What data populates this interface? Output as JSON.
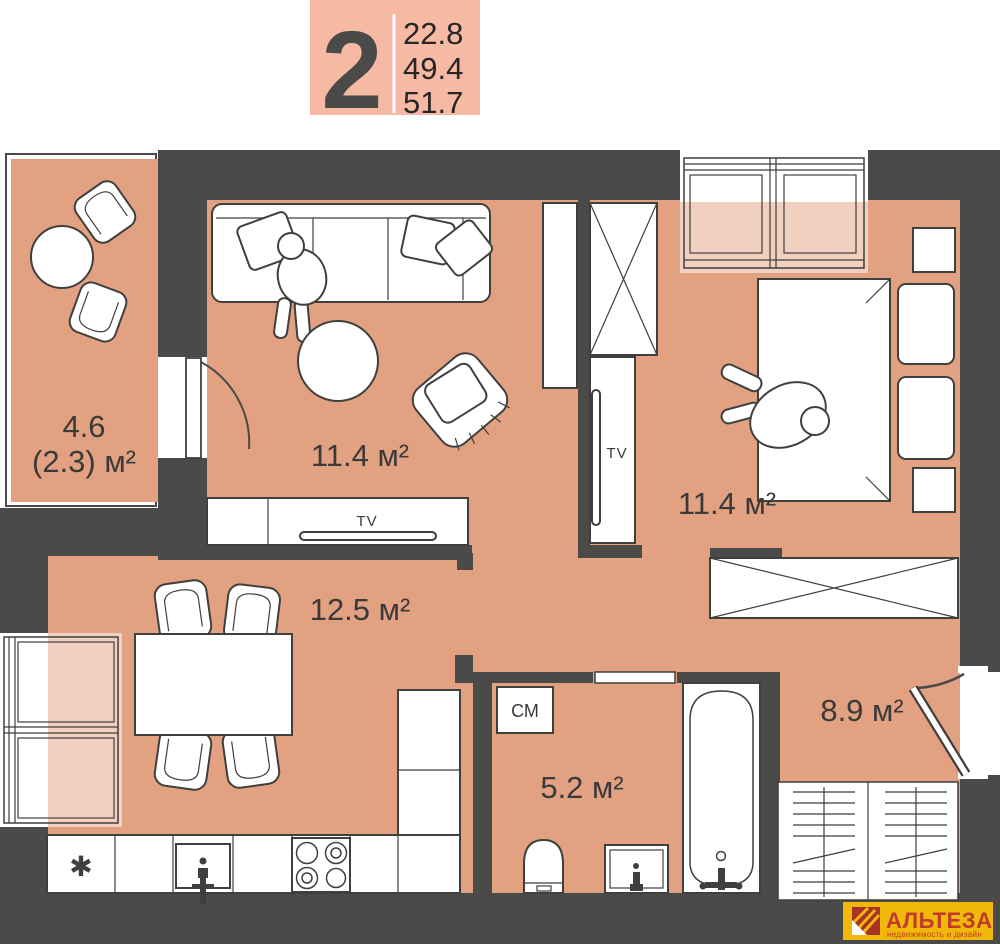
{
  "badge": {
    "rooms_count": "2",
    "areas": [
      "22.8",
      "49.4",
      "51.7"
    ]
  },
  "labels": {
    "balcony_area": "4.6",
    "balcony_area_reduced": "(2.3) м²",
    "living_room_area": "11.4 м²",
    "bedroom_area": "11.4 м²",
    "kitchen_area": "12.5 м²",
    "bathroom_area": "5.2 м²",
    "hallway_area": "8.9 м²",
    "washing_machine": "СМ",
    "tv_living": "TV",
    "tv_bedroom": "TV",
    "fridge_symbol": "✱"
  },
  "logo": {
    "brand": "АЛЬТЕЗА",
    "tagline": "недвижимость и дизайн"
  },
  "colors": {
    "wall": "#4a4a49",
    "floor": "#e2a181",
    "window_light": "rgba(255,255,255,0.5)",
    "badge_bg": "#f6b9a4",
    "badge_digit": "#4a4a49",
    "badge_numbers": "#262626",
    "logo_bg": "#f1b70a",
    "logo_text": "#c03b28",
    "logo_icon": "#a93226",
    "furniture_line": "#3f3f3e",
    "label_text": "#3a3a3a"
  }
}
